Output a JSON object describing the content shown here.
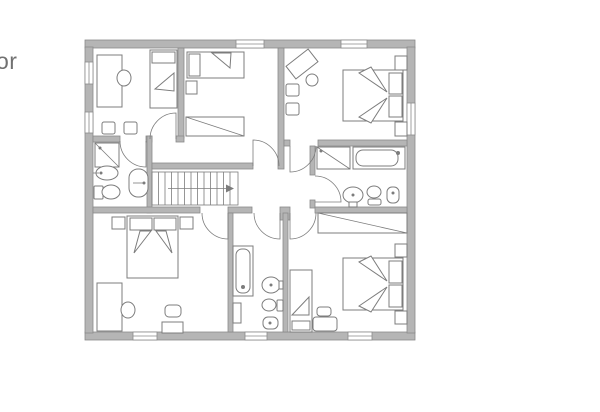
{
  "floor_label": {
    "text": "or"
  },
  "plan": {
    "colors": {
      "wall": "#b5b5b5",
      "wall-edge": "#8a8a8a",
      "line": "#7c7c7c",
      "floor": "#ffffff",
      "label": "#717171"
    },
    "stairs": {
      "treads": 12,
      "arrow_direction": "right"
    },
    "doors_count": 8,
    "windows": [
      {
        "wall": "top",
        "room": "bedroom-top-middle"
      },
      {
        "wall": "top",
        "room": "bedroom-top-right"
      },
      {
        "wall": "left",
        "room": "bedroom-top-left",
        "position": "upper"
      },
      {
        "wall": "left",
        "room": "bedroom-top-left",
        "position": "lower"
      },
      {
        "wall": "right",
        "room": "bedroom-top-right"
      },
      {
        "wall": "bottom",
        "room": "bedroom-bottom-left"
      },
      {
        "wall": "bottom",
        "room": "bathroom-bottom-middle"
      },
      {
        "wall": "bottom",
        "room": "bedroom-bottom-right"
      }
    ],
    "rooms": [
      {
        "id": "bedroom-top-left",
        "label": "Bedroom",
        "furniture": [
          "desk",
          "desk-chair",
          "single-bed",
          "chair",
          "chair"
        ]
      },
      {
        "id": "bedroom-top-middle",
        "label": "Bedroom",
        "furniture": [
          "single-bed",
          "nightstand",
          "wardrobe"
        ]
      },
      {
        "id": "bedroom-top-right",
        "label": "Bedroom",
        "furniture": [
          "desk",
          "desk-chair",
          "chair",
          "chair",
          "double-bed",
          "nightstand",
          "nightstand"
        ]
      },
      {
        "id": "bathroom-left",
        "label": "Bathroom",
        "furniture": [
          "shower",
          "washbasin",
          "toilet",
          "bidet"
        ]
      },
      {
        "id": "bathroom-right",
        "label": "Bathroom",
        "furniture": [
          "shower",
          "bathtub",
          "washbasin",
          "toilet",
          "bidet"
        ]
      },
      {
        "id": "bathroom-bottom-middle",
        "label": "Bathroom",
        "furniture": [
          "bathtub",
          "shelf",
          "washbasin",
          "toilet",
          "bidet"
        ]
      },
      {
        "id": "bedroom-bottom-left",
        "label": "Bedroom",
        "furniture": [
          "double-bed",
          "nightstand",
          "nightstand",
          "desk",
          "desk-chair",
          "chair",
          "table"
        ]
      },
      {
        "id": "bedroom-bottom-right",
        "label": "Bedroom",
        "furniture": [
          "wardrobe",
          "single-bed",
          "double-bed",
          "nightstand",
          "nightstand",
          "table",
          "chair"
        ]
      },
      {
        "id": "hallway",
        "label": "Hallway",
        "furniture": [
          "staircase"
        ]
      }
    ]
  }
}
